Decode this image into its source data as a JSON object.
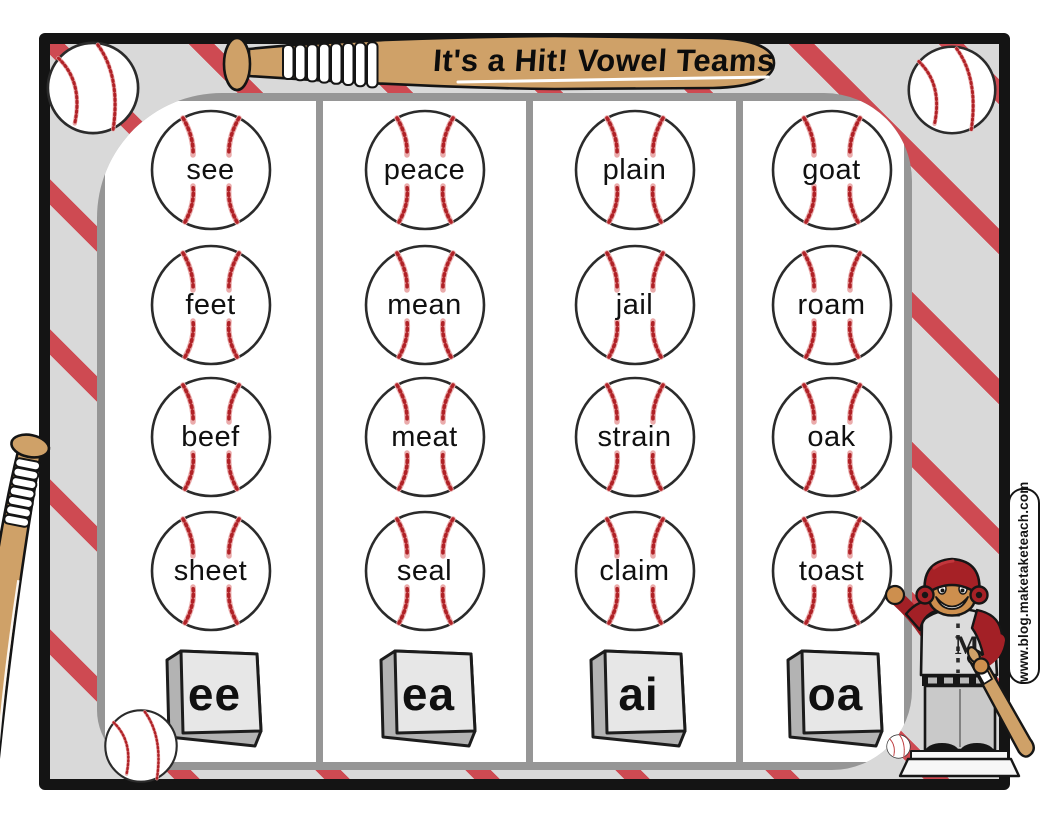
{
  "title": "It's a Hit! Vowel Teams",
  "website": "www.blog.maketaketeach.com",
  "columns": [
    {
      "team": "ee",
      "words": [
        "see",
        "feet",
        "beef",
        "sheet"
      ]
    },
    {
      "team": "ea",
      "words": [
        "peace",
        "mean",
        "meat",
        "seal"
      ]
    },
    {
      "team": "ai",
      "words": [
        "plain",
        "jail",
        "strain",
        "claim"
      ]
    },
    {
      "team": "oa",
      "words": [
        "goat",
        "roam",
        "oak",
        "toast"
      ]
    }
  ],
  "colors": {
    "stripe_red": "#ce4a52",
    "field_gray": "#d9d9d9",
    "frame_black": "#141414",
    "panel_border_gray": "#969696",
    "bat_tan": "#cfa168",
    "stitch_red": "#b02227",
    "helmet_red": "#a62126",
    "base_top": "#e7e7e7",
    "base_side": "#b3b3b3"
  },
  "icons": {
    "baseball": "white circle with red stitch seams",
    "bat": "tan baseball bat with white grip tape",
    "base_plate": "3d gray base pad",
    "player": "cartoon batter with red helmet"
  }
}
